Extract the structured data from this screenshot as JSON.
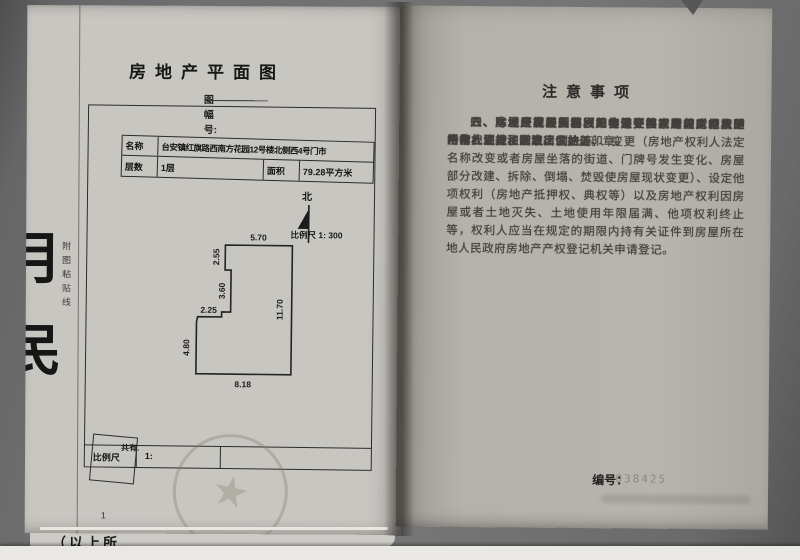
{
  "colors": {
    "photo_bg": "#6f6f6f",
    "paper_left": "#c8c6c1",
    "paper_right": "#b5b2ac",
    "ink": "#2b2b2b",
    "stamp_gray": "#7d766a"
  },
  "left_page": {
    "title": "房地产平面图",
    "sheet_no_label": "图幅号:",
    "margin_vertical_text": "附图粘贴线",
    "edge_glyphs": [
      "月",
      "民"
    ],
    "info_table": {
      "name_label": "名称",
      "name_value": "台安镇红旗路西南方花园12号楼北侧西4号门市",
      "floors_label": "层数",
      "floors_value": "1层",
      "area_label": "面积",
      "area_value": "79.28平方米"
    },
    "north_label": "北",
    "scale_note": "比例尺 1: 300",
    "dims": {
      "top": "5.70",
      "left_upper": "2.55",
      "left_mid": "3.60",
      "step": "2.25",
      "left_lower": "4.80",
      "bottom": "8.18",
      "right": "11.70"
    },
    "shared_label": "共有.",
    "scale_row": {
      "label": "比例尺",
      "value": "1:"
    },
    "page_number": "1",
    "cutoff_text": "（以上所…"
  },
  "right_page": {
    "title": "注意事项",
    "paragraphs": [
      "一、本证是房屋所有权的合法证件。房屋所有权受中华人民共和国法律保护。",
      "二、房屋所有权人必须严格遵守国家有关房地产的法律、法规和规章。",
      "三、房地产发生转移（买卖、交换、赠与、继承、析产、划拨、转让、判决等）、变更（房地产权利人法定名称改变或者房屋坐落的街道、门牌号发生变化、房屋部分改建、拆除、倒塌、焚毁使房屋现状变更）、设定他项权利（房地产抵押权、典权等）以及房地产权利因房屋或者土地灭失、土地使用年限届满、他项权利终止等，权利人应当在规定的期限内持有关证件到房屋所在地人民政府房地产产权登记机关申请登记。",
      "四、除发证机关及填发单位外，其它单位或个人不得在此证上注记事项或加盖印章。",
      "五、房地产管理部门因工作需要核查产权时，房屋所有权证持证人应出示此证。",
      "六、本证应妥善保管，如有遗失、损毁的，须及时申请补发。"
    ],
    "serial_label": "编号：",
    "serial_value": "00038425"
  }
}
